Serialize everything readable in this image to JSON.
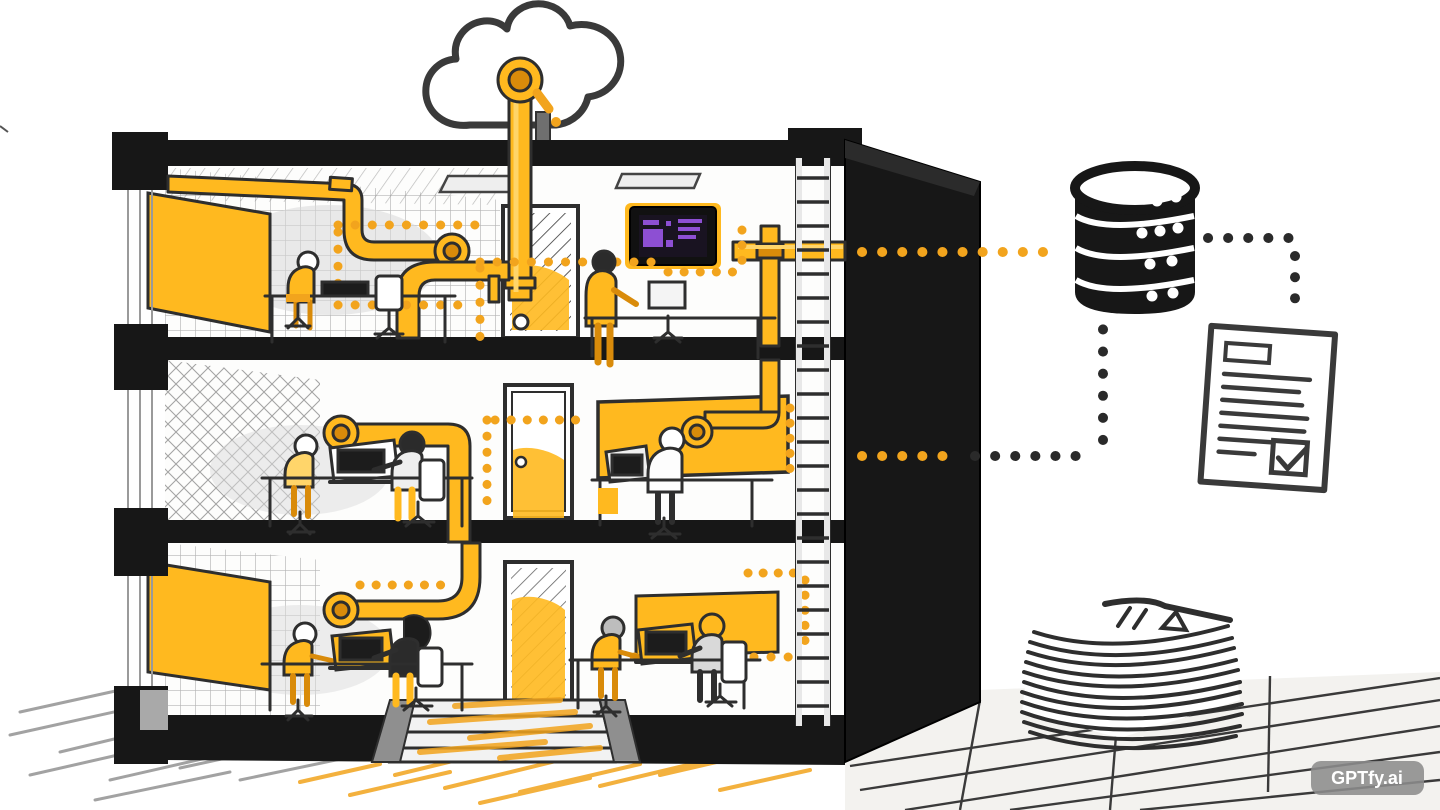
{
  "watermark": {
    "label": "GPTfy.ai"
  },
  "palette": {
    "background": "#ffffff",
    "ink": "#262626",
    "ink_soft": "#555555",
    "black_fill": "#171717",
    "orange": "#F2A41D",
    "orange_bright": "#FFB91F",
    "orange_light": "#FFD56A",
    "orange_deep": "#D98B0A",
    "gray_wall": "#c7c7c7",
    "gray_light": "#e3e3e3",
    "grid_line": "#b5b5b5",
    "screen_bg": "#191321",
    "screen_purple": "#8d4fd3",
    "watermark_bg": "#8c8c8c",
    "watermark_text": "#ffffff"
  },
  "scene": {
    "type": "hand-drawn office building cutaway diagram",
    "floors": 3,
    "people_per_floor": {
      "top": 2,
      "middle": 3,
      "bottom": 4
    },
    "icons": [
      "cloud-icon",
      "database-icon",
      "document-check-icon",
      "paper-stack-icon",
      "ladder-icon",
      "wall-display-icon"
    ],
    "flows": [
      "building pipes to cloud",
      "building dotted line to database",
      "database dotted line to checked document"
    ]
  }
}
